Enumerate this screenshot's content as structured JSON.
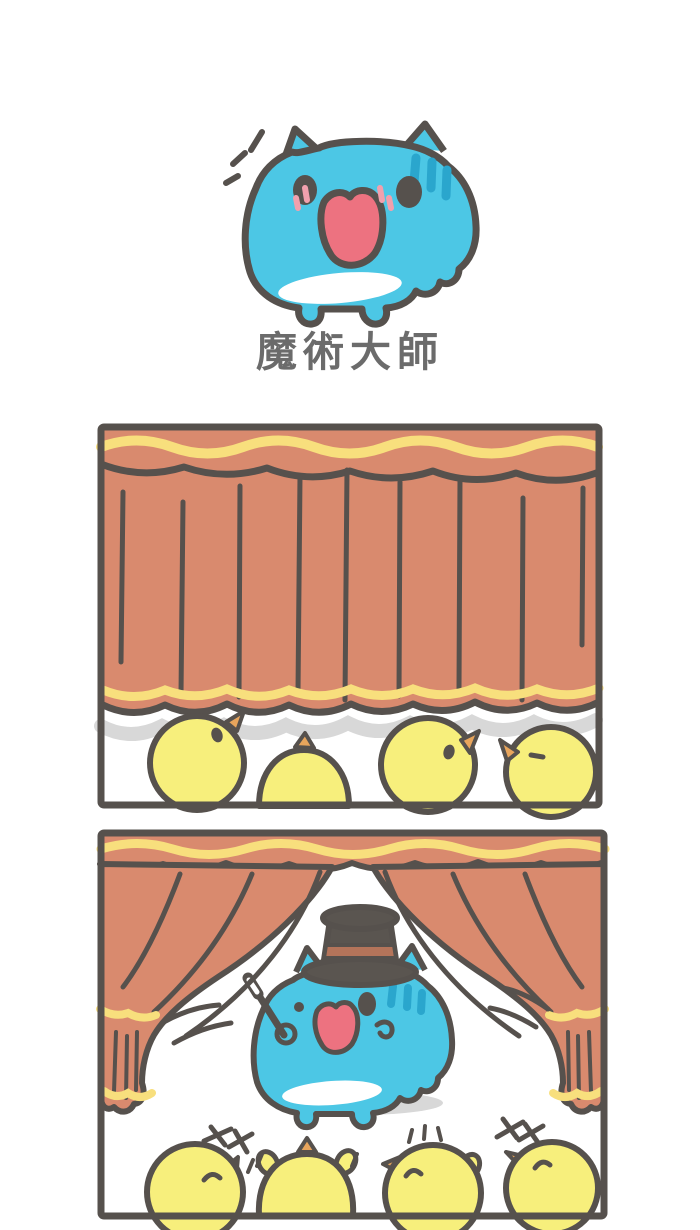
{
  "comic": {
    "title": "魔術大師"
  },
  "colors": {
    "background": "#ffffff",
    "outline": "#56514d",
    "title_gray": "#6b6b6b",
    "curtain": "#d98a6e",
    "trim_yellow": "#f8df7d",
    "chick_yellow": "#f7ef7c",
    "beak_orange": "#e8a55c",
    "cat_blue": "#4cc7e5",
    "cat_stripe": "#2aa6cd",
    "mouth_pink": "#ed7280",
    "blush_pink": "#f2a0ad",
    "hat_gray": "#5a5550",
    "hat_band": "#b4745a",
    "shadow_gray": "#d8d8d8",
    "belly_white": "#ffffff"
  }
}
